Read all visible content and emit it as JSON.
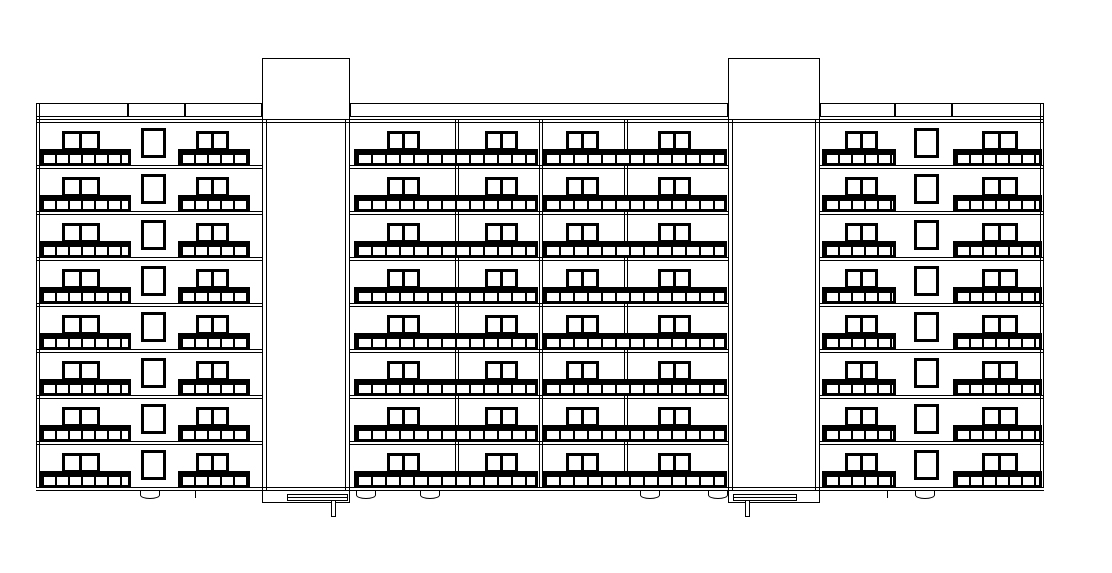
{
  "drawing": {
    "kind": "architectural-front-elevation",
    "description": "Eight-storey apartment block elevation with two roof-level stair towers, balconies with railings, and entrance canopies",
    "colors": {
      "line": "#000000",
      "background": "#ffffff"
    },
    "canvas": {
      "width": 1112,
      "height": 573
    },
    "building": {
      "left": 36,
      "right": 1044,
      "edge_inner_offset": 4,
      "parapet_top": 103,
      "parapet_bottom": 117,
      "roof_slab_y": [
        119,
        122
      ],
      "first_slab_y": 119,
      "floors": 8,
      "floor_height": 46,
      "ground_y": [
        487,
        490
      ]
    },
    "parapet_segments": [
      [
        36,
        128
      ],
      [
        128,
        185
      ],
      [
        185,
        262
      ],
      [
        350,
        728
      ],
      [
        820,
        895
      ],
      [
        895,
        952
      ],
      [
        952,
        1044
      ]
    ],
    "slab_segments": [
      [
        36,
        262
      ],
      [
        350,
        728
      ],
      [
        820,
        1044
      ]
    ],
    "towers": [
      {
        "x1": 262,
        "x2": 350,
        "top": 58,
        "base_bottom": 502,
        "canopy": {
          "x1": 287,
          "x2": 348,
          "y": 494,
          "h": 7,
          "post_x": 331,
          "post_w": 5,
          "post_bottom": 517
        }
      },
      {
        "x1": 728,
        "x2": 820,
        "top": 58,
        "base_bottom": 502,
        "canopy": {
          "x1": 733,
          "x2": 797,
          "y": 494,
          "h": 7,
          "post_x": 745,
          "post_w": 5,
          "post_bottom": 517
        }
      }
    ],
    "bay_dividers": [
      455,
      539,
      624
    ],
    "balconies": [
      {
        "x1": 39,
        "x2": 131,
        "seg": 13,
        "windows": [
          {
            "x": 62,
            "w": 38
          }
        ]
      },
      {
        "x1": 178,
        "x2": 250,
        "seg": 13,
        "windows": [
          {
            "x": 196,
            "w": 33
          }
        ]
      },
      {
        "x1": 354,
        "x2": 538,
        "seg": 14,
        "windows": [
          {
            "x": 387,
            "w": 33
          },
          {
            "x": 485,
            "w": 33
          }
        ]
      },
      {
        "x1": 542,
        "x2": 727,
        "seg": 14,
        "windows": [
          {
            "x": 566,
            "w": 33
          },
          {
            "x": 658,
            "w": 33
          }
        ]
      },
      {
        "x1": 822,
        "x2": 896,
        "seg": 13,
        "windows": [
          {
            "x": 845,
            "w": 33
          }
        ]
      },
      {
        "x1": 953,
        "x2": 1042,
        "seg": 13,
        "windows": [
          {
            "x": 982,
            "w": 36
          }
        ]
      }
    ],
    "balcony_window": {
      "top_offset": 12,
      "h": 20,
      "frame": 3
    },
    "railing": {
      "bar_offset": 30,
      "bar_h": 6,
      "baluster_offset": 36,
      "baluster_h": 10
    },
    "small_windows": [
      {
        "x": 141,
        "w": 25
      },
      {
        "x": 914,
        "w": 25
      }
    ],
    "small_window": {
      "top_offset": 9,
      "h": 30,
      "frame": 3
    },
    "ground_arcs": {
      "centers": [
        150,
        366,
        430,
        650,
        718,
        925
      ],
      "width": 20,
      "depth": 8
    },
    "ground_ticks": {
      "x": [
        195,
        887
      ],
      "depth": 8
    }
  }
}
